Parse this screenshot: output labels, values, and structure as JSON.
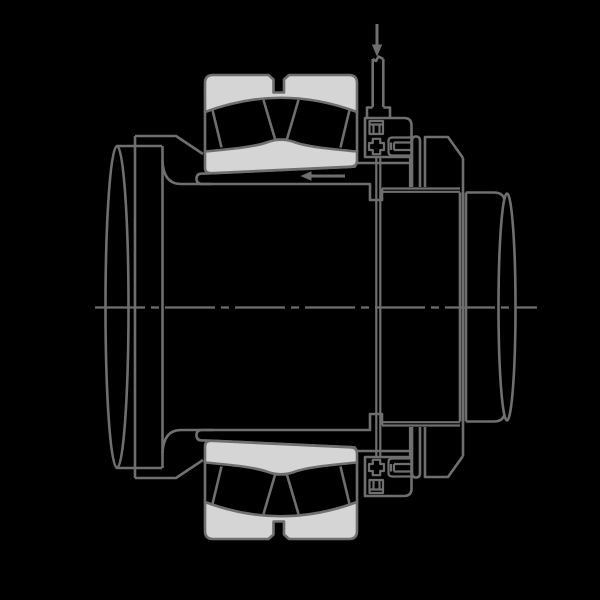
{
  "canvas": {
    "width": 600,
    "height": 600,
    "background": "#000000"
  },
  "colors": {
    "line": "#6f6f6f",
    "fill": "#d5d5d5",
    "background": "#000000"
  },
  "drawing": {
    "type": "technical-cross-section",
    "components": [
      "shaft-end-ellipse",
      "shaft-shoulder-collar",
      "adapter-sleeve",
      "spherical-roller-bearing-upper-half",
      "spherical-roller-bearing-lower-half",
      "oil-supply-fitting-upper",
      "oil-supply-fitting-lower",
      "oil-duct",
      "hydraulic-nut",
      "shaft-right-stub",
      "centerline"
    ],
    "arrows": [
      {
        "name": "oil-supply-arrow",
        "direction": "down"
      },
      {
        "name": "drive-up-arrow",
        "direction": "left"
      }
    ]
  }
}
